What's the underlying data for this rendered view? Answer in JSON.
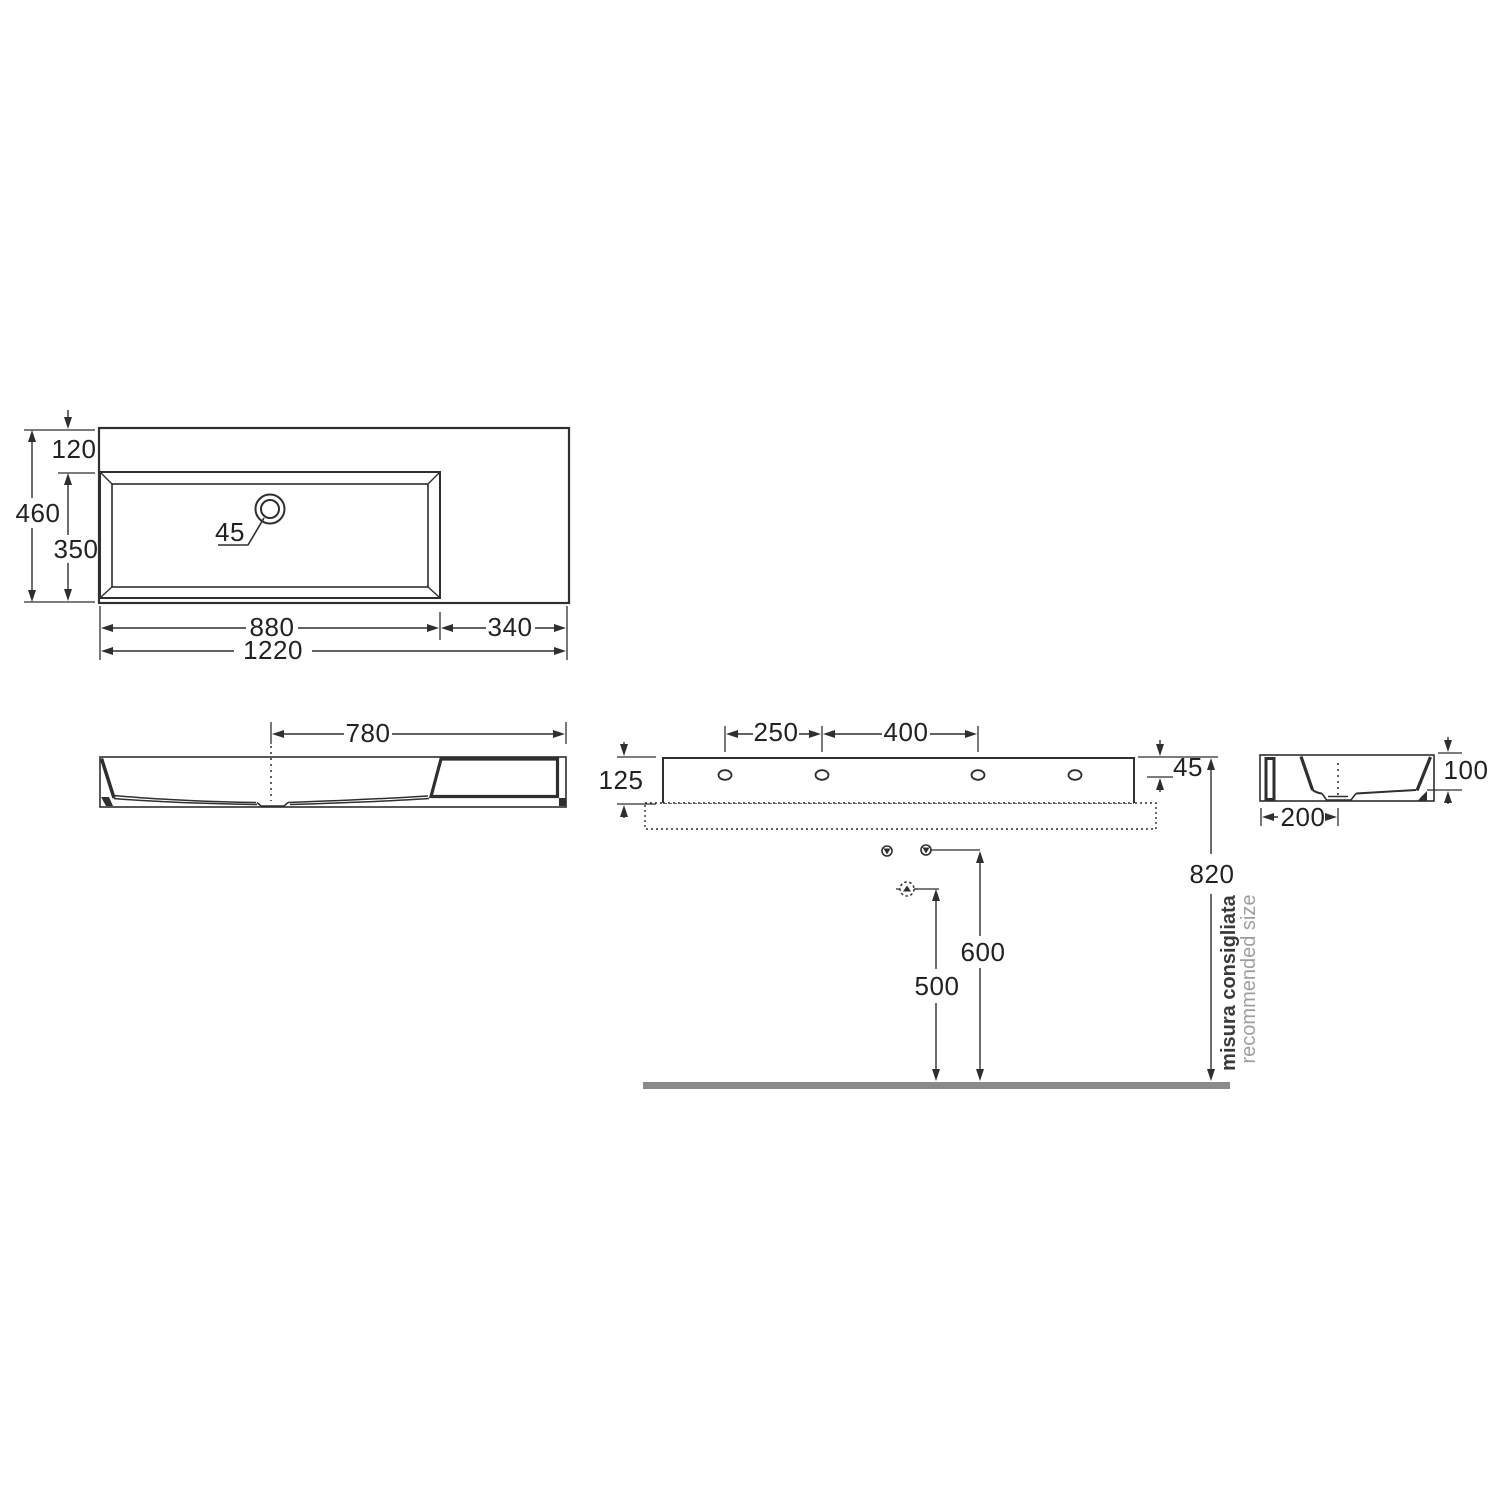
{
  "drawing": {
    "plan_view": {
      "back_offset": "120",
      "overall_depth": "460",
      "basin_depth": "350",
      "faucet_hole_diameter": "45",
      "basin_width": "880",
      "side_ledge_width": "340",
      "overall_width": "1220"
    },
    "front_view": {
      "drain_to_right_edge": "780"
    },
    "rear_view": {
      "fixing_hole_pitch_left": "250",
      "fixing_hole_pitch_right": "400",
      "apron_height": "125",
      "fixing_hole_drop": "45"
    },
    "side_view": {
      "drain_centre_depth": "200",
      "bowl_depth": "100"
    },
    "installation": {
      "trap_outlet_height": "500",
      "water_supply_height": "600",
      "rim_height": "820",
      "note_primary": "misura consigliata",
      "note_secondary": "recommended size"
    }
  },
  "colors": {
    "line": "#2f2f2f",
    "floor": "#8a8a8a",
    "note_secondary_text": "#9e9e9e"
  }
}
